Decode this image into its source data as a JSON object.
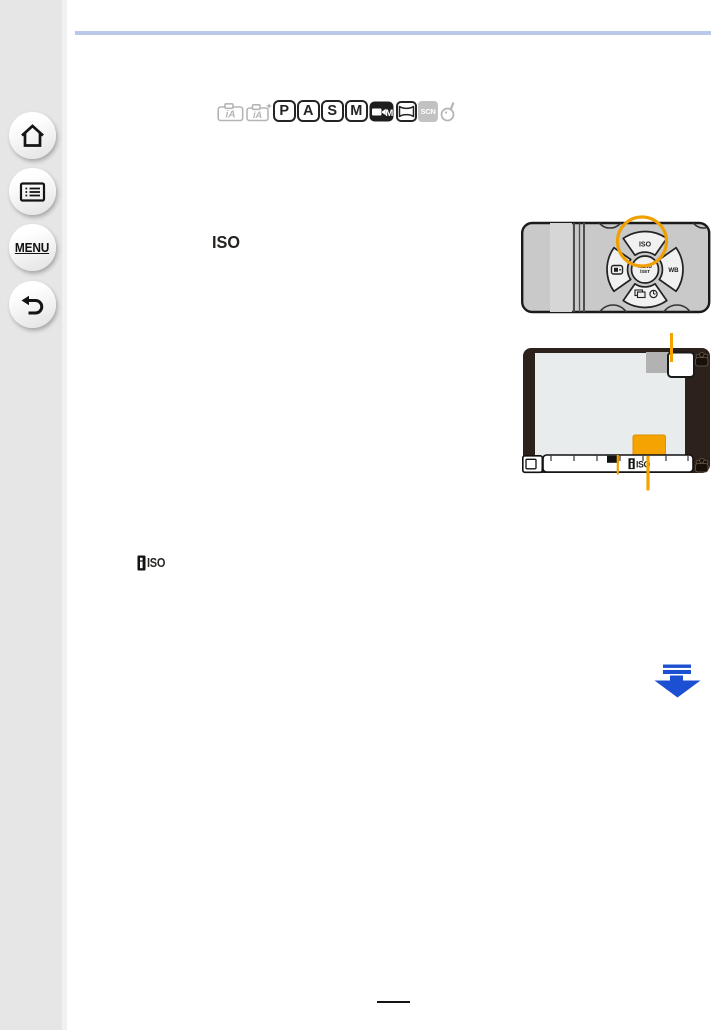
{
  "page": {
    "background": "#ffffff",
    "top_rule_color": "#b9c7e9",
    "page_number_rule_color": "#151515"
  },
  "sidebar": {
    "background": "#e6e6e6",
    "menu_label": "MENU"
  },
  "mode_bar": {
    "ia_label": "iA",
    "ia_plus_label": "iA",
    "plus_sign": "+",
    "program": "P",
    "aperture": "A",
    "shutter": "S",
    "manual": "M",
    "creative_video": "M",
    "scene": "SCN"
  },
  "content": {
    "iso_heading": "ISO",
    "intelligent_iso_label": "ISO"
  },
  "camera_dpad": {
    "iso_button": "ISO",
    "menu_set_line1": "MENU",
    "menu_set_line2": "/SET",
    "wb_button": "WB",
    "highlight_color": "#f0a000",
    "body_color": "#c9c9c9"
  },
  "camera_screen": {
    "iso_bar_label": "ISO",
    "highlight_color": "#f5a300",
    "frame_color": "#2c211b",
    "screen_color": "#e9eced"
  },
  "continuation_arrow_color": "#1d4fd2"
}
